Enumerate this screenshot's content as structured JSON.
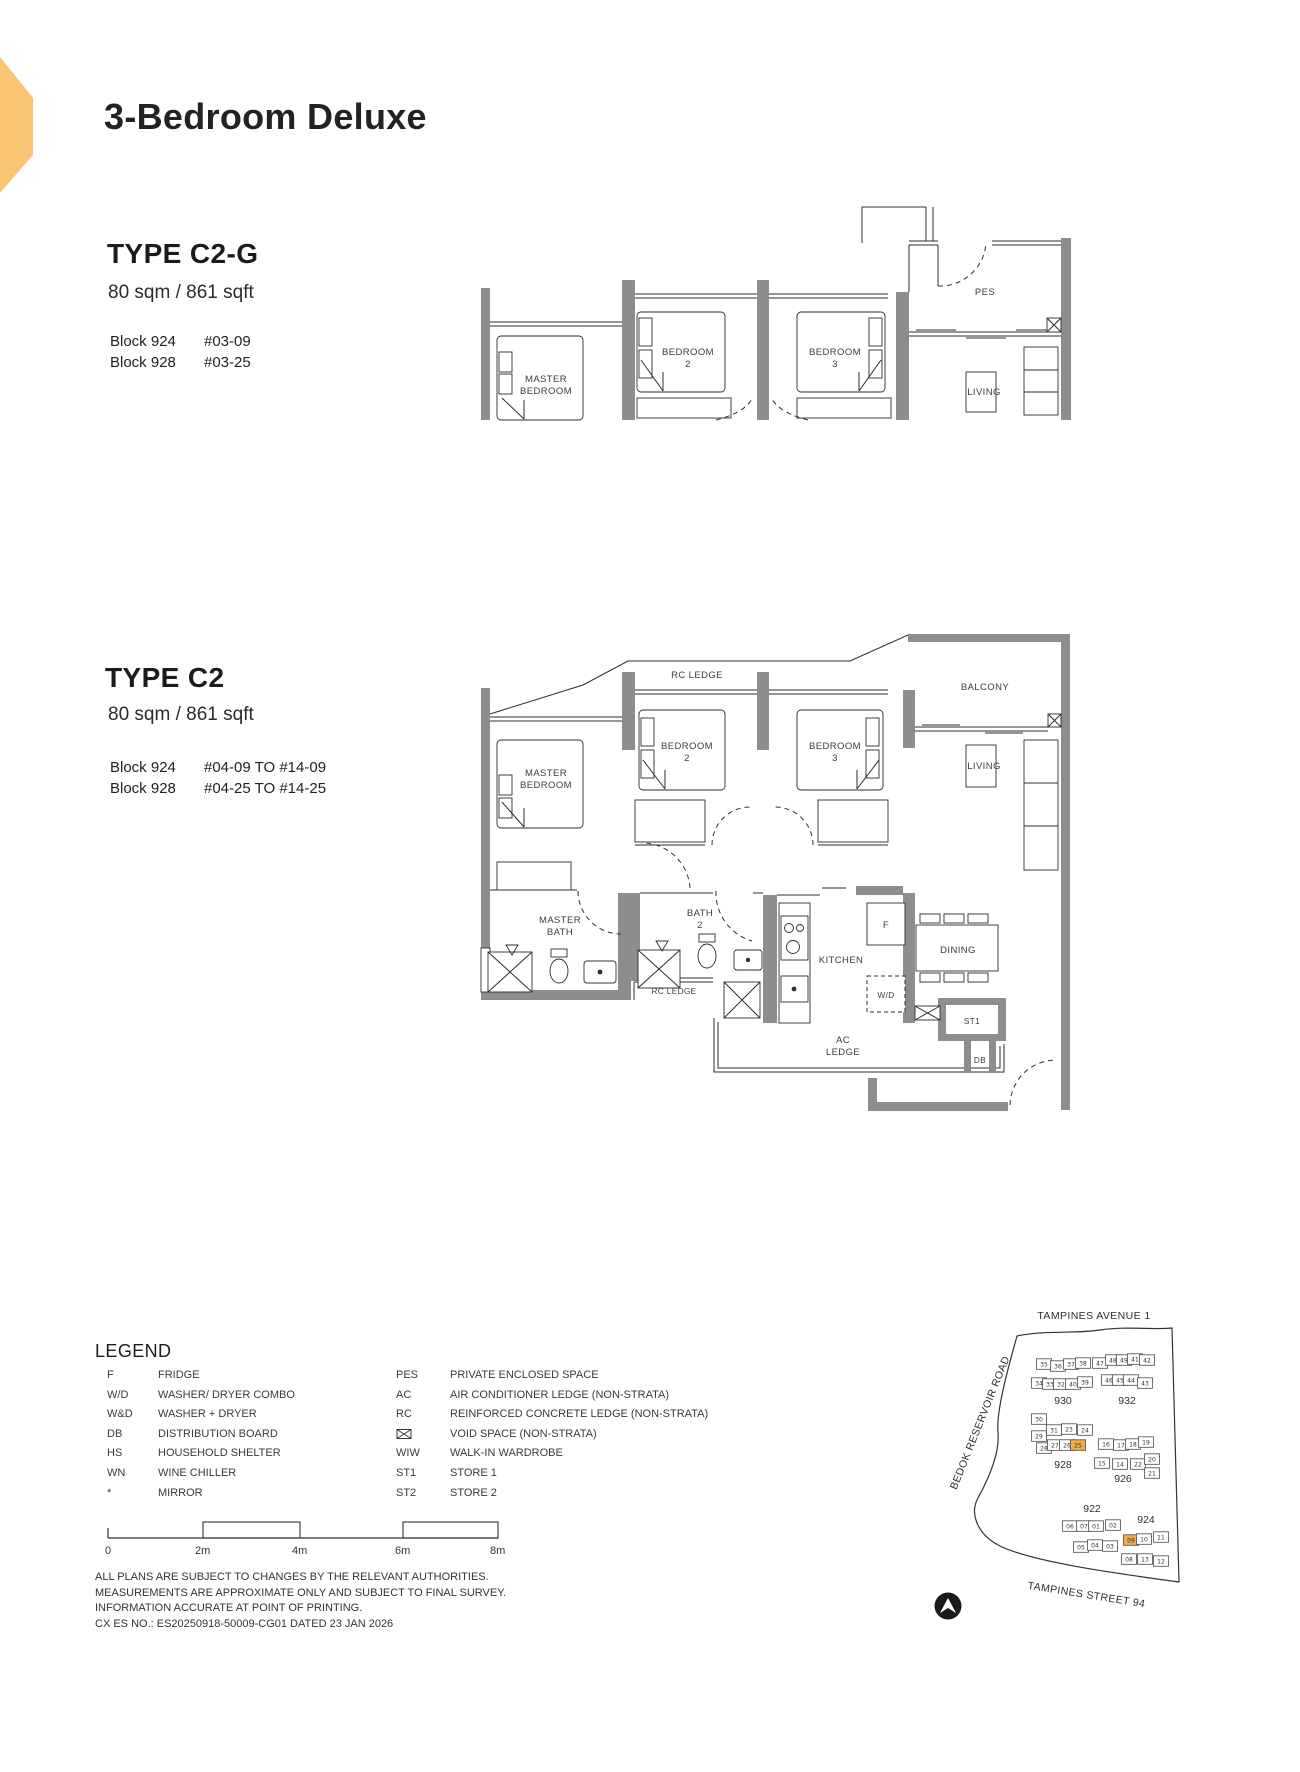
{
  "header": {
    "title": "3-Bedroom Deluxe"
  },
  "colors": {
    "accent": "#F9C574",
    "map_highlight": "#F0AC45",
    "wall_gray": "#8D8D8D"
  },
  "unit_types": [
    {
      "name": "TYPE C2-G",
      "area": "80 sqm / 861 sqft",
      "stacks": [
        {
          "block": "Block 924",
          "units": "#03-09"
        },
        {
          "block": "Block 928",
          "units": "#03-25"
        }
      ]
    },
    {
      "name": "TYPE C2",
      "area": "80 sqm / 861 sqft",
      "stacks": [
        {
          "block": "Block 924",
          "units": "#04-09 TO #14-09"
        },
        {
          "block": "Block 928",
          "units": "#04-25 TO #14-25"
        }
      ]
    }
  ],
  "plan1": {
    "labels": {
      "master_1": "MASTER",
      "master_2": "BEDROOM",
      "bedroom2_1": "BEDROOM",
      "bedroom2_2": "2",
      "bedroom3_1": "BEDROOM",
      "bedroom3_2": "3",
      "pes": "PES",
      "living": "LIVING"
    }
  },
  "plan2": {
    "labels": {
      "rc_ledge": "RC LEDGE",
      "balcony": "BALCONY",
      "master_1": "MASTER",
      "master_2": "BEDROOM",
      "bedroom2_1": "BEDROOM",
      "bedroom2_2": "2",
      "bedroom3_1": "BEDROOM",
      "bedroom3_2": "3",
      "living": "LIVING",
      "master_bath_1": "MASTER",
      "master_bath_2": "BATH",
      "bath2_1": "BATH",
      "bath2_2": "2",
      "rc_ledge2": "RC LEDGE",
      "kitchen": "KITCHEN",
      "fridge": "F",
      "wd": "W/D",
      "dining": "DINING",
      "st1": "ST1",
      "db": "DB",
      "ac_1": "AC",
      "ac_2": "LEDGE"
    }
  },
  "legend": {
    "heading": "LEGEND",
    "left": [
      [
        "F",
        "FRIDGE"
      ],
      [
        "W/D",
        "WASHER/ DRYER COMBO"
      ],
      [
        "W&D",
        "WASHER + DRYER"
      ],
      [
        "DB",
        "DISTRIBUTION BOARD"
      ],
      [
        "HS",
        "HOUSEHOLD SHELTER"
      ],
      [
        "WN",
        "WINE CHILLER"
      ],
      [
        "*",
        "MIRROR"
      ]
    ],
    "right": [
      [
        "PES",
        "PRIVATE ENCLOSED SPACE"
      ],
      [
        "AC",
        "AIR CONDITIONER LEDGE (NON-STRATA)"
      ],
      [
        "RC",
        "REINFORCED CONCRETE LEDGE (NON-STRATA)"
      ],
      [
        "",
        "VOID SPACE (NON-STRATA)"
      ],
      [
        "WIW",
        "WALK-IN WARDROBE"
      ],
      [
        "ST1",
        "STORE 1"
      ],
      [
        "ST2",
        "STORE 2"
      ]
    ]
  },
  "scale": {
    "labels": [
      "0",
      "2m",
      "4m",
      "6m",
      "8m"
    ]
  },
  "disclaimer": {
    "lines": [
      "ALL PLANS ARE SUBJECT TO CHANGES BY THE RELEVANT AUTHORITIES.",
      "MEASUREMENTS ARE APPROXIMATE ONLY AND SUBJECT TO FINAL SURVEY.",
      "INFORMATION ACCURATE AT POINT OF PRINTING.",
      "CX ES NO.: ES20250918-50009-CG01 DATED 23 JAN 2026"
    ]
  },
  "map": {
    "streets": {
      "top": "TAMPINES AVENUE 1",
      "left": "BEDOK RESERVOIR ROAD",
      "bottom": "TAMPINES STREET 94"
    },
    "blocks": [
      {
        "label": "930",
        "label_pos": [
          1063,
          1404
        ],
        "units": [
          {
            "n": "35",
            "x": 1044,
            "y": 1364
          },
          {
            "n": "36",
            "x": 1058,
            "y": 1366
          },
          {
            "n": "37",
            "x": 1071,
            "y": 1364
          },
          {
            "n": "38",
            "x": 1083,
            "y": 1363
          },
          {
            "n": "47",
            "x": 1100,
            "y": 1363
          },
          {
            "n": "34",
            "x": 1039,
            "y": 1383
          },
          {
            "n": "33",
            "x": 1050,
            "y": 1384
          },
          {
            "n": "32",
            "x": 1061,
            "y": 1384
          },
          {
            "n": "40",
            "x": 1073,
            "y": 1384
          },
          {
            "n": "39",
            "x": 1085,
            "y": 1382
          }
        ]
      },
      {
        "label": "932",
        "label_pos": [
          1127,
          1404
        ],
        "units": [
          {
            "n": "48",
            "x": 1113,
            "y": 1360
          },
          {
            "n": "49",
            "x": 1124,
            "y": 1360
          },
          {
            "n": "41",
            "x": 1135,
            "y": 1359
          },
          {
            "n": "42",
            "x": 1147,
            "y": 1360
          },
          {
            "n": "46",
            "x": 1109,
            "y": 1380
          },
          {
            "n": "45",
            "x": 1120,
            "y": 1380
          },
          {
            "n": "44",
            "x": 1131,
            "y": 1380
          },
          {
            "n": "43",
            "x": 1145,
            "y": 1383
          }
        ]
      },
      {
        "label": "928",
        "label_pos": [
          1063,
          1468
        ],
        "units": [
          {
            "n": "30",
            "x": 1039,
            "y": 1419
          },
          {
            "n": "29",
            "x": 1039,
            "y": 1436
          },
          {
            "n": "31",
            "x": 1054,
            "y": 1430
          },
          {
            "n": "23",
            "x": 1069,
            "y": 1429
          },
          {
            "n": "24",
            "x": 1085,
            "y": 1430
          },
          {
            "n": "28",
            "x": 1044,
            "y": 1448
          },
          {
            "n": "27",
            "x": 1055,
            "y": 1445
          },
          {
            "n": "26",
            "x": 1067,
            "y": 1445
          },
          {
            "n": "25",
            "x": 1078,
            "y": 1445,
            "hl": true
          }
        ]
      },
      {
        "label": "926",
        "label_pos": [
          1123,
          1482
        ],
        "units": [
          {
            "n": "16",
            "x": 1106,
            "y": 1444
          },
          {
            "n": "17",
            "x": 1121,
            "y": 1445
          },
          {
            "n": "18",
            "x": 1133,
            "y": 1444
          },
          {
            "n": "19",
            "x": 1146,
            "y": 1442
          },
          {
            "n": "15",
            "x": 1102,
            "y": 1463
          },
          {
            "n": "14",
            "x": 1120,
            "y": 1464
          },
          {
            "n": "22",
            "x": 1138,
            "y": 1464
          },
          {
            "n": "20",
            "x": 1152,
            "y": 1459
          },
          {
            "n": "21",
            "x": 1152,
            "y": 1473
          }
        ]
      },
      {
        "label": "922",
        "label_pos": [
          1092,
          1512
        ],
        "units": [
          {
            "n": "06",
            "x": 1070,
            "y": 1526
          },
          {
            "n": "07",
            "x": 1084,
            "y": 1526
          },
          {
            "n": "01",
            "x": 1096,
            "y": 1526
          },
          {
            "n": "02",
            "x": 1113,
            "y": 1525
          },
          {
            "n": "05",
            "x": 1081,
            "y": 1547
          },
          {
            "n": "04",
            "x": 1095,
            "y": 1545
          },
          {
            "n": "03",
            "x": 1110,
            "y": 1546
          }
        ]
      },
      {
        "label": "924",
        "label_pos": [
          1146,
          1523
        ],
        "units": [
          {
            "n": "09",
            "x": 1131,
            "y": 1540,
            "hl": true
          },
          {
            "n": "10",
            "x": 1144,
            "y": 1539
          },
          {
            "n": "11",
            "x": 1161,
            "y": 1537
          },
          {
            "n": "08",
            "x": 1129,
            "y": 1559
          },
          {
            "n": "13",
            "x": 1145,
            "y": 1559
          },
          {
            "n": "12",
            "x": 1161,
            "y": 1561
          }
        ]
      }
    ]
  }
}
